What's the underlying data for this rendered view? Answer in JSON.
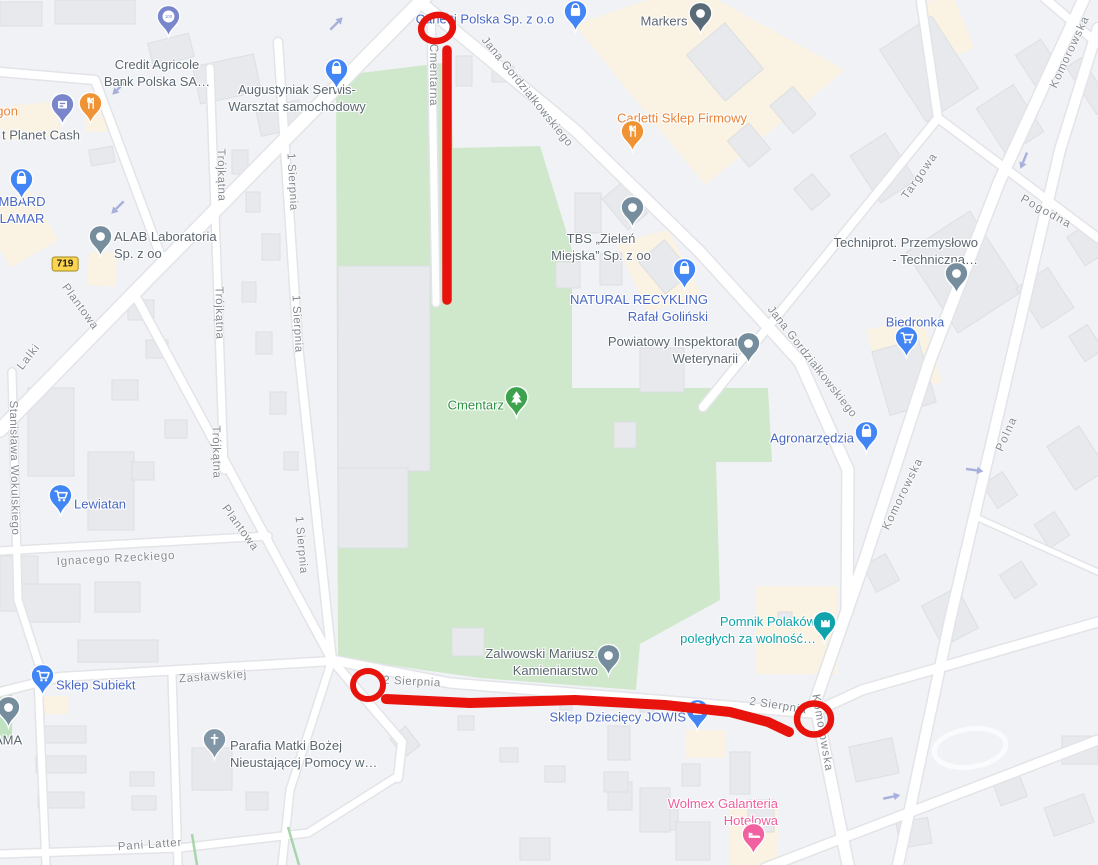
{
  "map": {
    "road_sign": {
      "label": "719"
    },
    "pois": [
      {
        "id": "credit-agricole",
        "label": "Credit Agricole\nBank Polska SA…",
        "color": "#5b6670",
        "icon": "bank-pin",
        "pin_color": "#7986cb"
      },
      {
        "id": "planet-cash",
        "label": "t Planet Cash",
        "color": "#5b6670",
        "icon": "atm-pin",
        "pin_color": "#7986cb"
      },
      {
        "id": "gon",
        "label": "gon",
        "color": "#e8833a",
        "icon": "restaurant-pin",
        "pin_color": "#ef9334"
      },
      {
        "id": "lombard-lamar",
        "label": "MBARD\nLAMAR",
        "color": "#4867c3",
        "icon": "shopping-bag-pin",
        "pin_color": "#4285f4"
      },
      {
        "id": "augustyniak",
        "label": "Augustyniak Serwis-\nWarsztat samochodowy",
        "color": "#5b6670",
        "icon": "shopping-bag-pin",
        "pin_color": "#4285f4"
      },
      {
        "id": "carletti-polska",
        "label": "Carletti Polska Sp. z o.o",
        "color": "#4867c3",
        "icon": "shopping-bag-pin",
        "pin_color": "#4285f4"
      },
      {
        "id": "markers",
        "label": "Markers",
        "color": "#5b6670",
        "icon": "place-pin",
        "pin_color": "#586b77"
      },
      {
        "id": "carletti-sklep-firmowy",
        "label": "Carletti Sklep Firmowy",
        "color": "#e8833a",
        "icon": "restaurant-pin",
        "pin_color": "#ef9334"
      },
      {
        "id": "alab",
        "label": "ALAB Laboratoria\nSp. z oo",
        "color": "#5b6670",
        "icon": "place-pin",
        "pin_color": "#768d9d"
      },
      {
        "id": "tbs-zielen",
        "label": "TBS „Zieleń\nMiejska” Sp. z oo",
        "color": "#5b6670",
        "icon": "place-pin",
        "pin_color": "#768d9d"
      },
      {
        "id": "natural-recykling",
        "label": "NATURAL RECYKLING\nRafał Goliński",
        "color": "#4867c3",
        "icon": "shopping-bag-pin",
        "pin_color": "#4285f4"
      },
      {
        "id": "powiatowy-inspektorat",
        "label": "Powiatowy Inspektorat\nWeterynarii",
        "color": "#5b6670",
        "icon": "place-pin",
        "pin_color": "#768d9d"
      },
      {
        "id": "techniprot",
        "label": "Techniprot. Przemysłowo\n- Techniczna…",
        "color": "#5b6670",
        "icon": "place-pin",
        "pin_color": "#768d9d"
      },
      {
        "id": "biedronka",
        "label": "Biedronka",
        "color": "#4867c3",
        "icon": "cart-pin",
        "pin_color": "#4285f4"
      },
      {
        "id": "agronarzedzia",
        "label": "Agronarzędzia",
        "color": "#4867c3",
        "icon": "shopping-bag-pin",
        "pin_color": "#4285f4"
      },
      {
        "id": "cmentarz",
        "label": "Cmentarz",
        "color": "#2d9242",
        "icon": "tree-pin",
        "pin_color": "#3da14d"
      },
      {
        "id": "lewiatan",
        "label": "Lewiatan",
        "color": "#4867c3",
        "icon": "cart-pin",
        "pin_color": "#4285f4"
      },
      {
        "id": "pomnik",
        "label": "Pomnik Polaków\npoległych za wolność…",
        "color": "#0da3a9",
        "icon": "monument-pin",
        "pin_color": "#11a3ab"
      },
      {
        "id": "zalwowski",
        "label": "Zalwowski Mariusz.\nKamieniarstwo",
        "color": "#5b6670",
        "icon": "place-pin",
        "pin_color": "#768d9d"
      },
      {
        "id": "jowis",
        "label": "Sklep Dziecięcy JOWIŚ",
        "color": "#4867c3",
        "icon": "shopping-bag-pin",
        "pin_color": "#4285f4"
      },
      {
        "id": "sklep-subiekt",
        "label": "Sklep Subiekt",
        "color": "#4867c3",
        "icon": "cart-pin",
        "pin_color": "#4285f4"
      },
      {
        "id": "ama",
        "label": "AMA",
        "color": "#5b6670",
        "icon": "place-pin",
        "pin_color": "#768d9d"
      },
      {
        "id": "parafia",
        "label": "Parafia Matki Bożej\nNieustającej Pomocy w…",
        "color": "#5b6670",
        "icon": "church-pin",
        "pin_color": "#8196a6"
      },
      {
        "id": "wolmex",
        "label": "Wolmex Galanteria\nHotelowa",
        "color": "#ef5f9e",
        "icon": "bed-pin",
        "pin_color": "#f1619f"
      }
    ],
    "streets": [
      {
        "id": "cmentarna",
        "label": "Cmentarna"
      },
      {
        "id": "jana-gordzialkowskiego-1",
        "label": "Jana Gordziałkowskiego"
      },
      {
        "id": "jana-gordzialkowskiego-2",
        "label": "Jana Gordziałkowskiego"
      },
      {
        "id": "komorowska-1",
        "label": "Komorowska"
      },
      {
        "id": "komorowska-2",
        "label": "Komorowska"
      },
      {
        "id": "komorowska-3",
        "label": "Komorowska"
      },
      {
        "id": "targowa",
        "label": "Targowa"
      },
      {
        "id": "pogodna",
        "label": "Pogodna"
      },
      {
        "id": "polna",
        "label": "Polna"
      },
      {
        "id": "trojkatna-1",
        "label": "Trójkątna"
      },
      {
        "id": "trojkatna-2",
        "label": "Trójkątna"
      },
      {
        "id": "trojkatna-3",
        "label": "Trójkątna"
      },
      {
        "id": "1-sierpnia-1",
        "label": "1 Sierpnia"
      },
      {
        "id": "1-sierpnia-2",
        "label": "1 Sierpnia"
      },
      {
        "id": "1-sierpnia-3",
        "label": "1 Sierpnia"
      },
      {
        "id": "plantowa-1",
        "label": "Plantowa"
      },
      {
        "id": "plantowa-2",
        "label": "Plantowa"
      },
      {
        "id": "lalki",
        "label": "Lalki"
      },
      {
        "id": "stanislawa-wokulskiego",
        "label": "Stanisława Wokulskiego"
      },
      {
        "id": "ignacego-rzeckiego",
        "label": "Ignacego Rzeckiego"
      },
      {
        "id": "zaslawskiej",
        "label": "Zasławskiej"
      },
      {
        "id": "2-sierpnia-1",
        "label": "2 Sierpnia"
      },
      {
        "id": "2-sierpnia-2",
        "label": "2 Sierpnia"
      },
      {
        "id": "pani-latter",
        "label": "Pani Latter"
      }
    ],
    "annotations": {
      "color": "#e8130c",
      "shapes": [
        {
          "kind": "ellipse",
          "cx": 437,
          "cy": 28,
          "rx": 16,
          "ry": 13,
          "rot": -12,
          "sw": 6.5
        },
        {
          "kind": "line",
          "points": [
            [
              447,
              50
            ],
            [
              447,
              300
            ]
          ],
          "sw": 9.5
        },
        {
          "kind": "ellipse",
          "cx": 368,
          "cy": 685,
          "rx": 15,
          "ry": 14,
          "rot": 0,
          "sw": 6
        },
        {
          "kind": "line",
          "points": [
            [
              386,
              699
            ],
            [
              470,
              703
            ],
            [
              575,
              700
            ],
            [
              665,
              705
            ],
            [
              730,
              712
            ],
            [
              768,
              722
            ],
            [
              789,
              732
            ]
          ],
          "sw": 10
        },
        {
          "kind": "ellipse",
          "cx": 814,
          "cy": 719,
          "rx": 17,
          "ry": 15.5,
          "rot": 0,
          "sw": 6.5
        }
      ]
    }
  }
}
